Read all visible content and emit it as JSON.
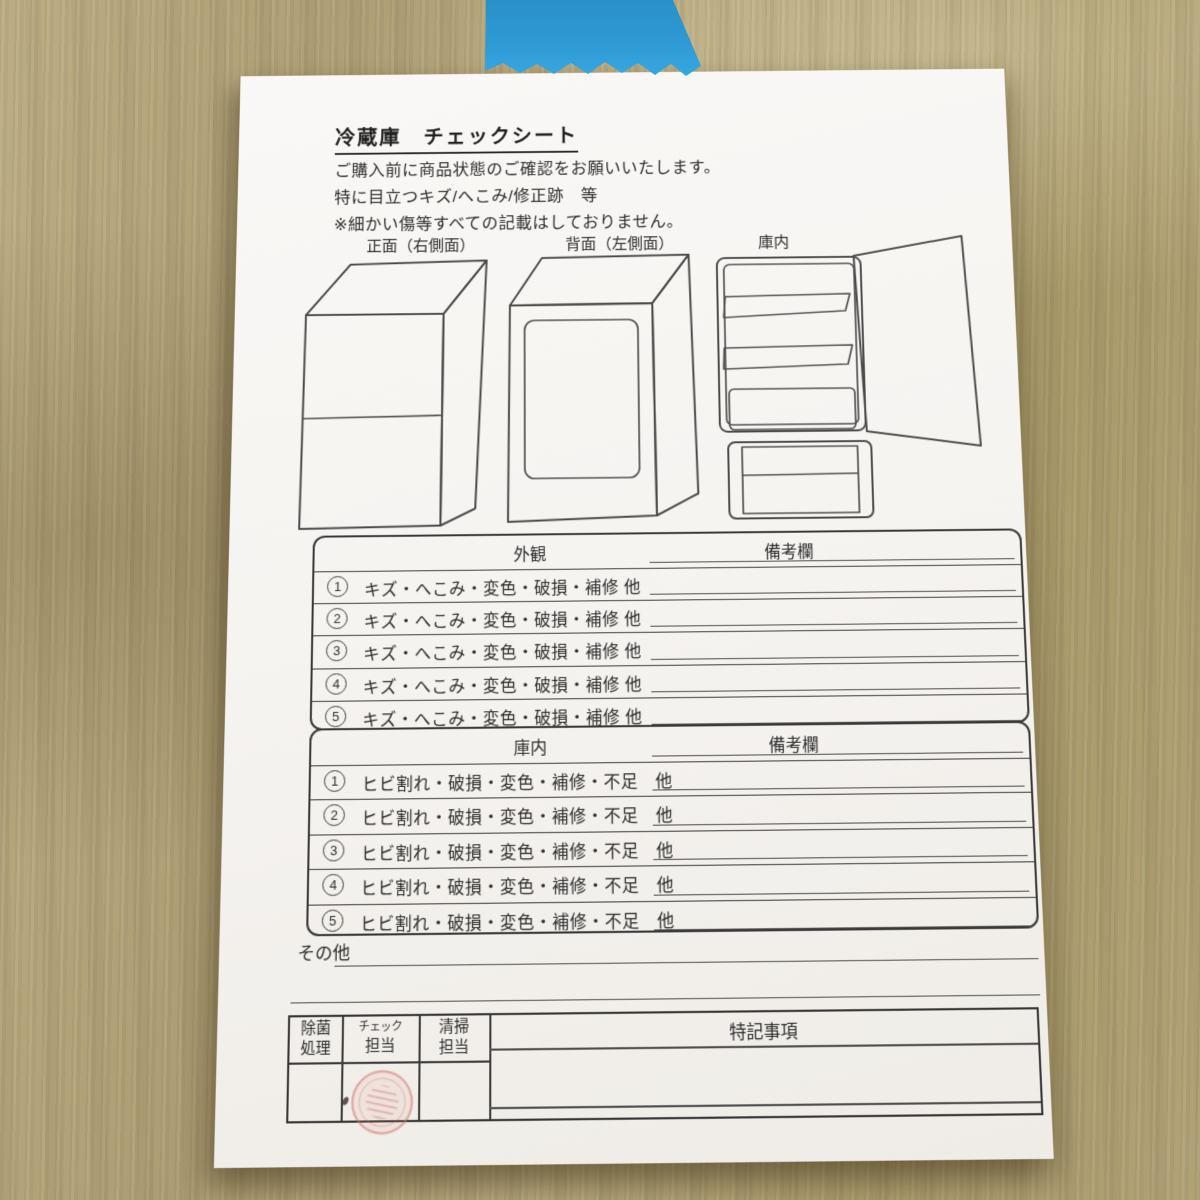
{
  "scene": {
    "wood_color": "#b0a176",
    "paper_color": "#f6f4f1",
    "tape": {
      "name": "blue-masking-tape",
      "color": "#2e9ad4"
    },
    "stamp": {
      "name": "red-hanko-stamp",
      "color": "#ce6c62"
    }
  },
  "doc": {
    "title": "冷蔵庫　チェックシート",
    "intro": [
      "ご購入前に商品状態のご確認をお願いいたします。",
      "特に目立つキズ/へこみ/修正跡　等",
      "※細かい傷等すべての記載はしておりません。"
    ],
    "diagram_labels": {
      "front": "正面（右側面）",
      "back": "背面（左側面）",
      "interior": "庫内"
    },
    "exterior_table": {
      "title": "外観",
      "remarks": "備考欄",
      "rows": [
        {
          "num": "1",
          "text": "キズ・へこみ・変色・破損・補修 他"
        },
        {
          "num": "2",
          "text": "キズ・へこみ・変色・破損・補修 他"
        },
        {
          "num": "3",
          "text": "キズ・へこみ・変色・破損・補修 他"
        },
        {
          "num": "4",
          "text": "キズ・へこみ・変色・破損・補修 他"
        },
        {
          "num": "5",
          "text": "キズ・へこみ・変色・破損・補修 他"
        }
      ]
    },
    "interior_table": {
      "title": "庫内",
      "remarks": "備考欄",
      "rows": [
        {
          "num": "1",
          "text": "ヒビ割れ・破損・変色・補修・不足　他"
        },
        {
          "num": "2",
          "text": "ヒビ割れ・破損・変色・補修・不足　他"
        },
        {
          "num": "3",
          "text": "ヒビ割れ・破損・変色・補修・不足　他"
        },
        {
          "num": "4",
          "text": "ヒビ割れ・破損・変色・補修・不足　他"
        },
        {
          "num": "5",
          "text": "ヒビ割れ・破損・変色・補修・不足　他"
        }
      ]
    },
    "other_label": "その他",
    "footer": {
      "sanitize": [
        "除菌",
        "処理"
      ],
      "check": [
        "チェック",
        "担当"
      ],
      "cleaning": [
        "清掃",
        "担当"
      ],
      "notes": "特記事項"
    }
  }
}
